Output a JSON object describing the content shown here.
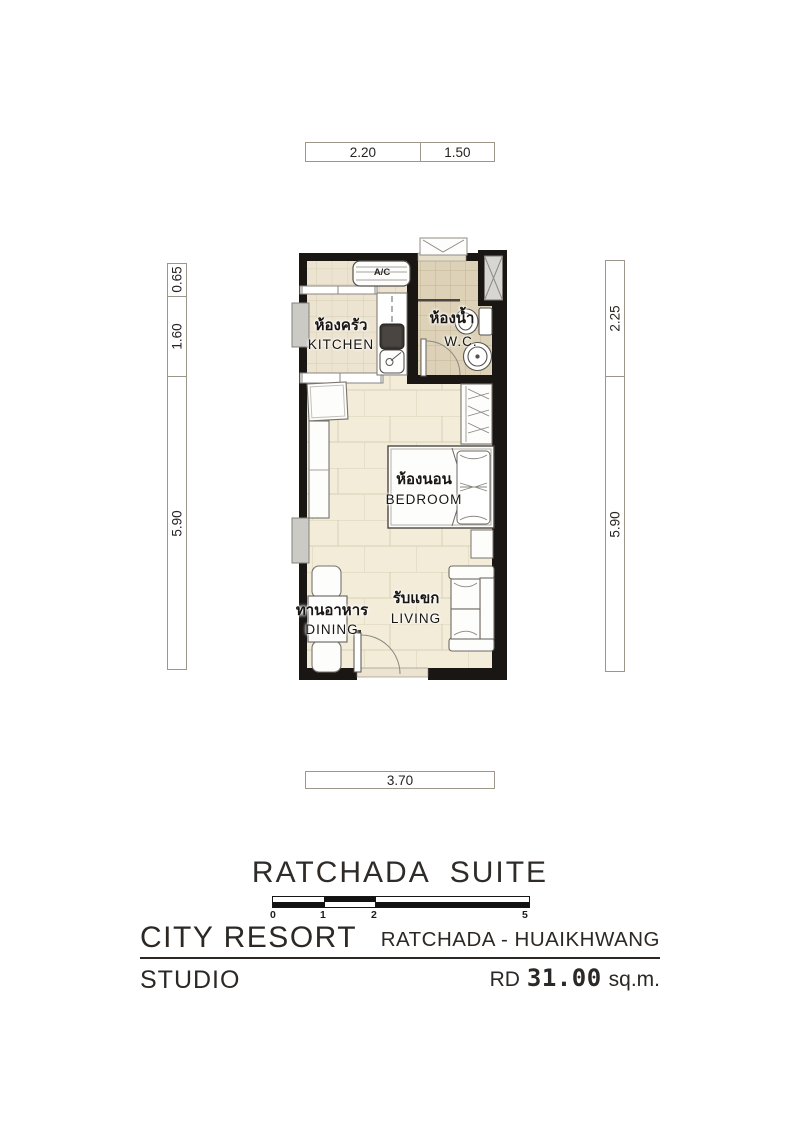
{
  "sheet": {
    "title": "RATCHADA  SUITE"
  },
  "dimensions": {
    "top": {
      "a": "2.20",
      "b": "1.50"
    },
    "left": {
      "a": "0.65",
      "b": "1.60",
      "c": "5.90"
    },
    "right": {
      "a": "2.25",
      "b": "5.90"
    },
    "bottom": {
      "a": "3.70"
    }
  },
  "rooms": {
    "kitchen": {
      "thai": "ห้องครัว",
      "en": "KITCHEN"
    },
    "wc": {
      "thai": "ห้องน้ำ",
      "en": "W.C."
    },
    "bedroom": {
      "thai": "ห้องนอน",
      "en": "BEDROOM"
    },
    "dining": {
      "thai": "ทานอาหาร",
      "en": "DINING"
    },
    "living": {
      "thai": "รับแขก",
      "en": "LIVING"
    },
    "ac_label": "A/C"
  },
  "scale_bar": {
    "labels": [
      "0",
      "1",
      "2",
      "5"
    ]
  },
  "footer": {
    "project": "CITY RESORT",
    "location": "RATCHADA - HUAIKHWANG",
    "unit_type": "STUDIO",
    "area_prefix": "RD",
    "area_value": "31.00",
    "area_unit": "sq.m."
  },
  "colors": {
    "wall": "#1a1613",
    "kitchen_floor": "#ece4d0",
    "wet_floor": "#ddd2b8",
    "main_floor": "#f2ecd9",
    "floor_grid": "#d2c8ac",
    "text": "#2b2825",
    "dim_border": "#9d968a"
  }
}
